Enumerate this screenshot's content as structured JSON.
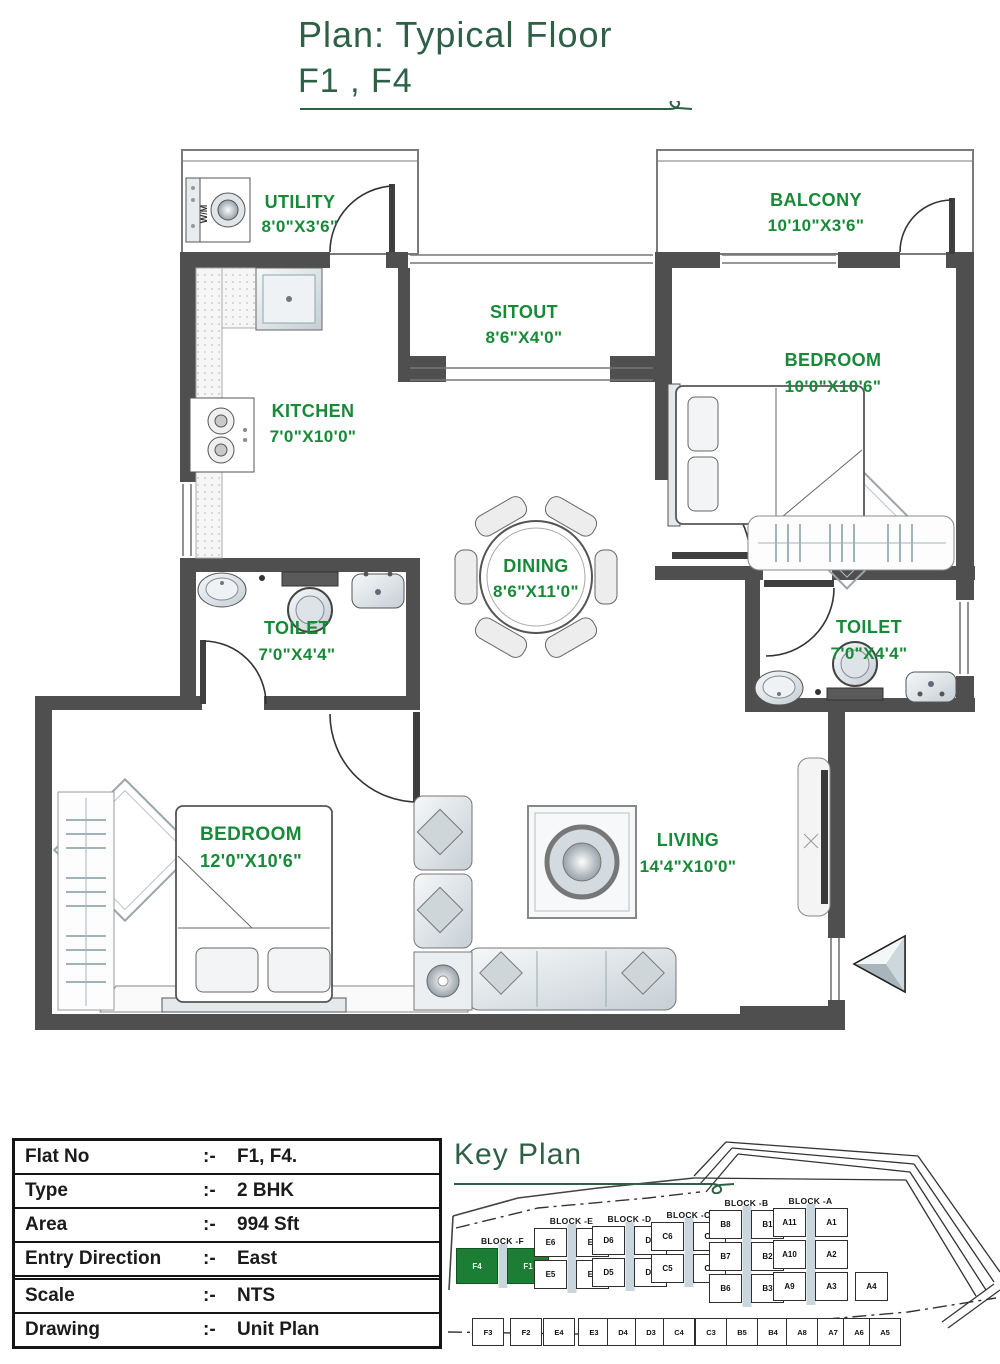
{
  "title": {
    "line1": "Plan: Typical Floor",
    "line2": "F1 , F4"
  },
  "colors": {
    "title_green": "#2d6045",
    "label_green": "#178a38",
    "wall_gray": "#4f4f4f",
    "keyplan_highlight": "#1c7e34"
  },
  "rooms": {
    "utility": {
      "name": "UTILITY",
      "dims": "8'0\"X3'6\""
    },
    "balcony": {
      "name": "BALCONY",
      "dims": "10'10\"X3'6\""
    },
    "sitout": {
      "name": "SITOUT",
      "dims": "8'6\"X4'0\""
    },
    "kitchen": {
      "name": "KITCHEN",
      "dims": "7'0\"X10'0\""
    },
    "bedroom1": {
      "name": "BEDROOM",
      "dims": "10'0\"X10'6\""
    },
    "dining": {
      "name": "DINING",
      "dims": "8'6\"X11'0\""
    },
    "toilet1": {
      "name": "TOILET",
      "dims": "7'0\"X4'4\""
    },
    "toilet2": {
      "name": "TOILET",
      "dims": "7'0\"X4'4\""
    },
    "bedroom2": {
      "name": "BEDROOM",
      "dims": "12'0\"X10'6\""
    },
    "living": {
      "name": "LIVING",
      "dims": "14'4\"X10'0\""
    }
  },
  "appliance_labels": {
    "washing_machine": "W/M"
  },
  "info_table": {
    "separator": ":-",
    "rows": [
      {
        "label": "Flat No",
        "value": "F1, F4."
      },
      {
        "label": "Type",
        "value": "2 BHK"
      },
      {
        "label": "Area",
        "value": "994 Sft"
      },
      {
        "label": "Entry Direction",
        "value": "East"
      },
      {
        "label": "Scale",
        "value": "NTS"
      },
      {
        "label": "Drawing",
        "value": "Unit Plan"
      }
    ]
  },
  "key_plan": {
    "title": "Key Plan",
    "blocks": [
      {
        "name": "BLOCK -F",
        "rows": [
          [
            "F4",
            "F1"
          ]
        ],
        "highlighted": [
          "F4",
          "F1"
        ]
      },
      {
        "name": "BLOCK -E",
        "rows": [
          [
            "E6",
            "E1"
          ],
          [
            "E5",
            "E2"
          ]
        ]
      },
      {
        "name": "BLOCK -D",
        "rows": [
          [
            "D6",
            "D1"
          ],
          [
            "D5",
            "D2"
          ]
        ]
      },
      {
        "name": "BLOCK -C",
        "rows": [
          [
            "C6",
            "C1"
          ],
          [
            "C5",
            "C2"
          ]
        ]
      },
      {
        "name": "BLOCK -B",
        "rows": [
          [
            "B8",
            "B1"
          ],
          [
            "B7",
            "B2"
          ],
          [
            "B6",
            "B3"
          ]
        ]
      },
      {
        "name": "BLOCK -A",
        "rows": [
          [
            "A11",
            "A1"
          ],
          [
            "A10",
            "A2"
          ],
          [
            "A9",
            "A3"
          ]
        ],
        "extra": "A4"
      }
    ],
    "front_row": [
      "F3",
      "F2",
      "E4",
      "E3",
      "D4",
      "D3",
      "C4",
      "C3",
      "B5",
      "B4",
      "A8",
      "A7",
      "A6",
      "A5"
    ]
  }
}
